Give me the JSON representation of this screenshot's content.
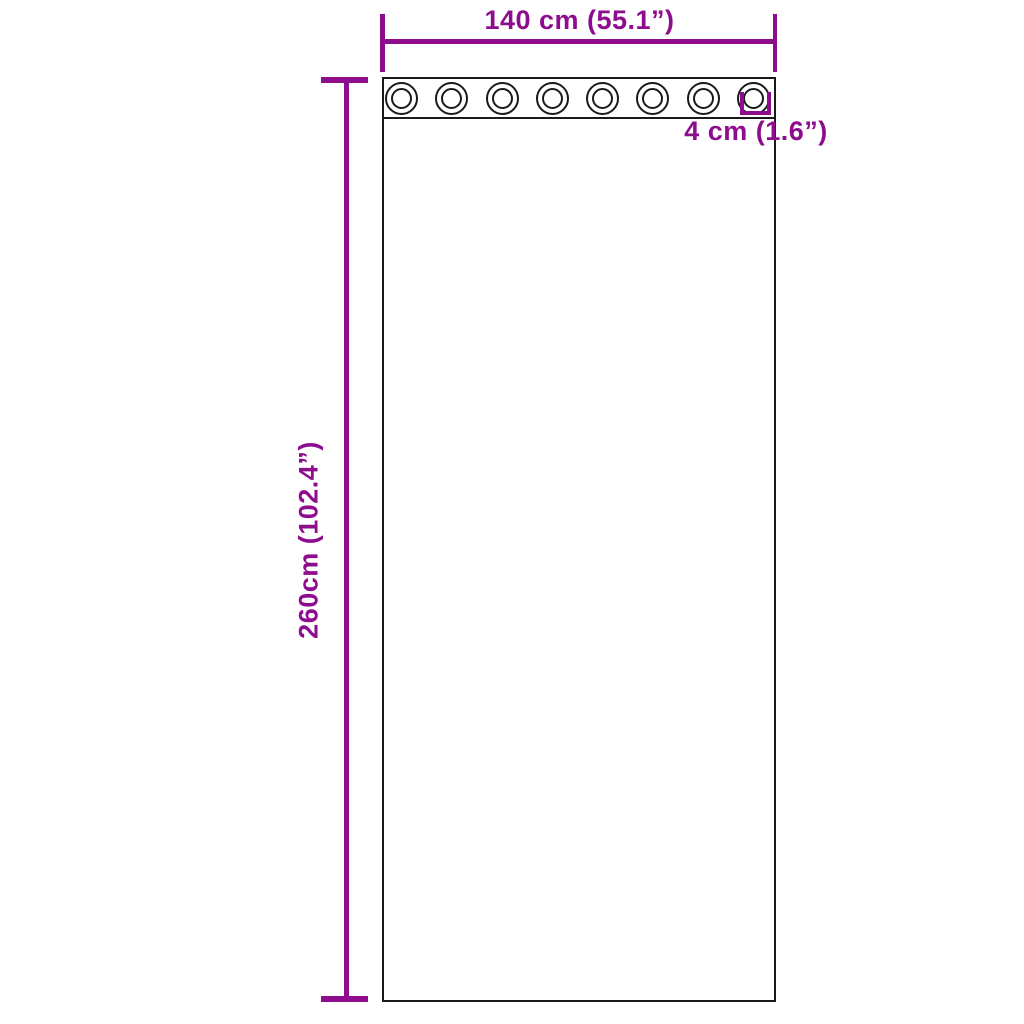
{
  "page": {
    "background": "#ffffff"
  },
  "diagram": {
    "type": "product-dimension-diagram",
    "subject": "curtain-with-grommets",
    "accent_color": "#8e0d8e",
    "line_color": "#1a1a1a",
    "curtain": {
      "fill": "#ffffff"
    },
    "grommets": {
      "count": 8
    },
    "dimensions": {
      "width": {
        "label": "140 cm (55.1”)"
      },
      "height": {
        "label": "260cm (102.4”)"
      },
      "grommet_hole": {
        "label": "4 cm (1.6”)"
      }
    }
  }
}
